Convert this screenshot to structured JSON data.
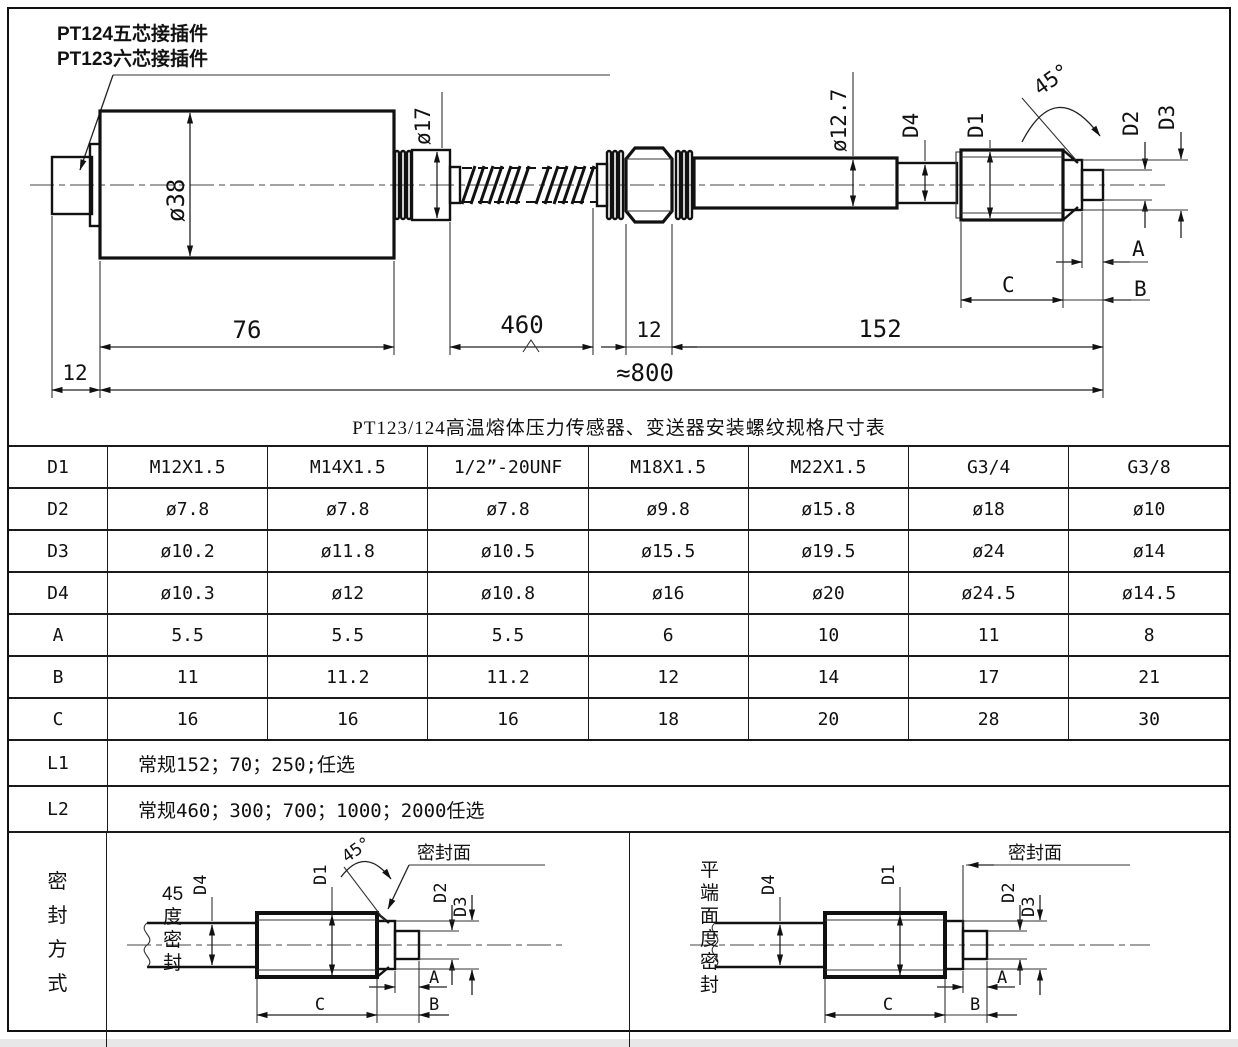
{
  "page": {
    "bg": "#ffffff",
    "line_color": "#1a1a1a"
  },
  "drawing": {
    "callout": {
      "line1": "PT124五芯接插件",
      "line2": "PT123六芯接插件"
    },
    "dims": {
      "body_dia": "ø38",
      "collar_dia": "ø17",
      "stem_dia": "ø12.7",
      "d4": "D4",
      "d1": "D1",
      "d2": "D2",
      "d3": "D3",
      "angle": "45°",
      "a": "A",
      "b": "B",
      "c": "C",
      "len_connector": "12",
      "len_body": "76",
      "len_capillary": "460",
      "len_hex": "12",
      "len_stem": "152",
      "len_total": "≈800"
    }
  },
  "table": {
    "title": "PT123/124高温熔体压力传感器、变送器安装螺纹规格尺寸表",
    "rows": [
      {
        "header": "D1",
        "cells": [
          "M12X1.5",
          "M14X1.5",
          "1/2”-20UNF",
          "M18X1.5",
          "M22X1.5",
          "G3/4",
          "G3/8"
        ]
      },
      {
        "header": "D2",
        "cells": [
          "ø7.8",
          "ø7.8",
          "ø7.8",
          "ø9.8",
          "ø15.8",
          "ø18",
          "ø10"
        ]
      },
      {
        "header": "D3",
        "cells": [
          "ø10.2",
          "ø11.8",
          "ø10.5",
          "ø15.5",
          "ø19.5",
          "ø24",
          "ø14"
        ]
      },
      {
        "header": "D4",
        "cells": [
          "ø10.3",
          "ø12",
          "ø10.8",
          "ø16",
          "ø20",
          "ø24.5",
          "ø14.5"
        ]
      },
      {
        "header": "A",
        "cells": [
          "5.5",
          "5.5",
          "5.5",
          "6",
          "10",
          "11",
          "8"
        ]
      },
      {
        "header": "B",
        "cells": [
          "11",
          "11.2",
          "11.2",
          "12",
          "14",
          "17",
          "21"
        ]
      },
      {
        "header": "C",
        "cells": [
          "16",
          "16",
          "16",
          "18",
          "20",
          "28",
          "30"
        ]
      },
      {
        "header": "L1",
        "note": "常规152；70；250;任选"
      },
      {
        "header": "L2",
        "note": "常规460；300；700；1000；2000任选"
      }
    ]
  },
  "seal": {
    "header": {
      "text": "密封方式",
      "chars": [
        "密",
        "封",
        "方",
        "式"
      ]
    },
    "left": {
      "label": "45度密封",
      "label_lines": [
        "45",
        "度",
        "密",
        "封"
      ],
      "seal_face": "密封面",
      "angle": "45°",
      "d4": "D4",
      "d1": "D1",
      "d2": "D2",
      "d3": "D3",
      "a": "A",
      "b": "B",
      "c": "C"
    },
    "right": {
      "label": "平端面度密封",
      "label_lines": [
        "平",
        "端",
        "面",
        "度",
        "密",
        "封"
      ],
      "seal_face": "密封面",
      "d4": "D4",
      "d1": "D1",
      "d2": "D2",
      "d3": "D3",
      "a": "A",
      "b": "B",
      "c": "C"
    }
  }
}
